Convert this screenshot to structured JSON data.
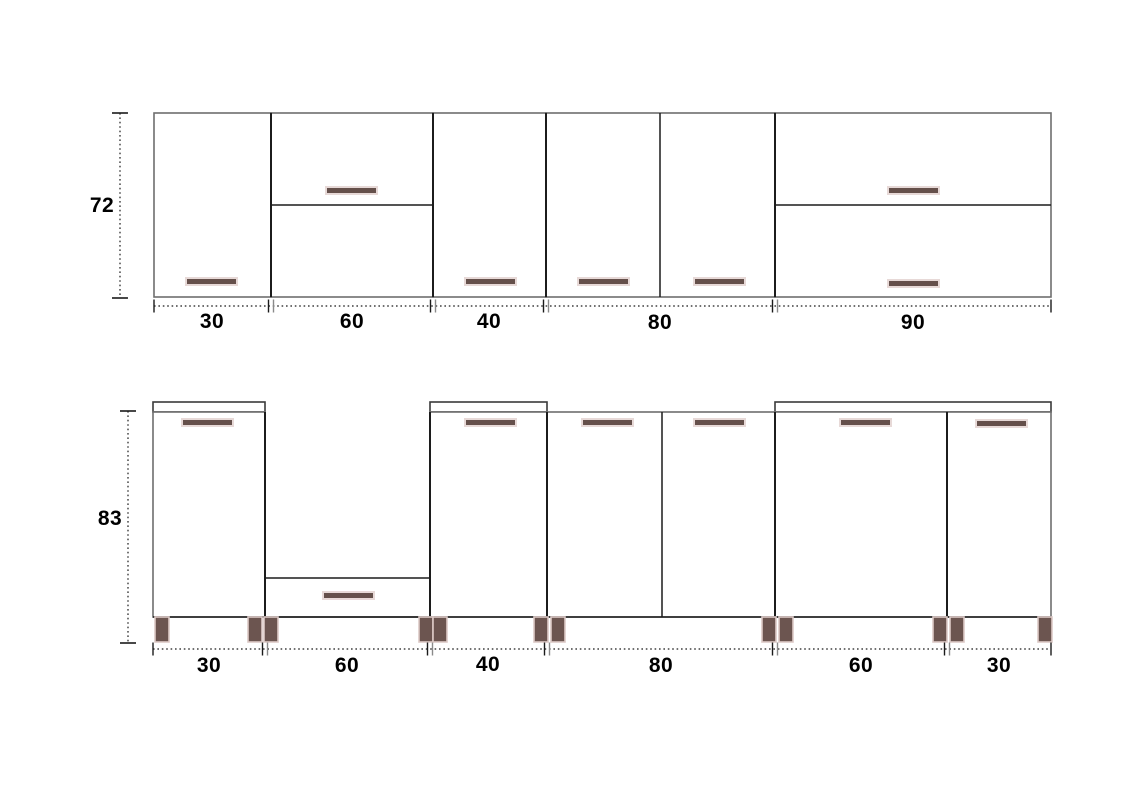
{
  "title": "Kitchen cabinets elevation drawing",
  "colors": {
    "background": "#ffffff",
    "cabinet_outline": "#6e6e6e",
    "divider_line": "#1c1c1c",
    "countertop_outline": "#3a3a3a",
    "handle_fill": "#65504b",
    "handle_outline": "#e7d9d7",
    "leg_fill": "#6c5550",
    "leg_outline": "#dcc9c6",
    "dim_line": "#1a1a1a",
    "label_color": "#000000"
  },
  "handle_size": {
    "w": 51,
    "h": 7
  },
  "wall_run": {
    "height_value": "72",
    "widths": [
      "30",
      "60",
      "40",
      "80",
      "90"
    ],
    "top": 113,
    "bottom": 297,
    "boundaries": [
      154,
      271,
      433,
      546,
      775,
      1051
    ],
    "horizontal_dividers": [
      {
        "x1": 271,
        "x2": 433,
        "y": 205
      },
      {
        "x1": 775,
        "x2": 1051,
        "y": 205
      }
    ],
    "vertical_dividers": [
      {
        "x": 660,
        "y1": 113,
        "y2": 297
      }
    ],
    "handles": [
      [
        186,
        278
      ],
      [
        326,
        187
      ],
      [
        465,
        278
      ],
      [
        578,
        278
      ],
      [
        694,
        278
      ],
      [
        888,
        187
      ],
      [
        888,
        280
      ]
    ],
    "dim_line_y": 306,
    "v_dim": {
      "x": 120,
      "y1": 113,
      "y2": 298
    }
  },
  "base_run": {
    "height_value": "83",
    "widths": [
      "30",
      "60",
      "40",
      "80",
      "60",
      "30"
    ],
    "top": 412,
    "bottom": 617,
    "boundaries": [
      153,
      265,
      430,
      547,
      775,
      947,
      1051
    ],
    "open_segments": [
      1
    ],
    "countertops": [
      {
        "x1": 153,
        "x2": 265
      },
      {
        "x1": 430,
        "x2": 547
      },
      {
        "x1": 775,
        "x2": 1051
      }
    ],
    "countertop_top": 402,
    "drawer": {
      "x1": 265,
      "x2": 430,
      "top": 578
    },
    "vertical_dividers": [
      {
        "x": 662,
        "y1": 412,
        "y2": 617
      }
    ],
    "handles": [
      [
        182,
        419
      ],
      [
        465,
        419
      ],
      [
        582,
        419
      ],
      [
        694,
        419
      ],
      [
        840,
        419
      ],
      [
        976,
        420
      ],
      [
        323,
        592
      ]
    ],
    "legs_x": [
      155,
      248,
      264,
      419,
      433,
      534,
      551,
      762,
      779,
      933,
      950,
      1038
    ],
    "leg": {
      "w": 14,
      "h": 25,
      "y": 617
    },
    "dim_line_y": 649,
    "v_dim": {
      "x": 128,
      "y1": 411,
      "y2": 643
    }
  }
}
